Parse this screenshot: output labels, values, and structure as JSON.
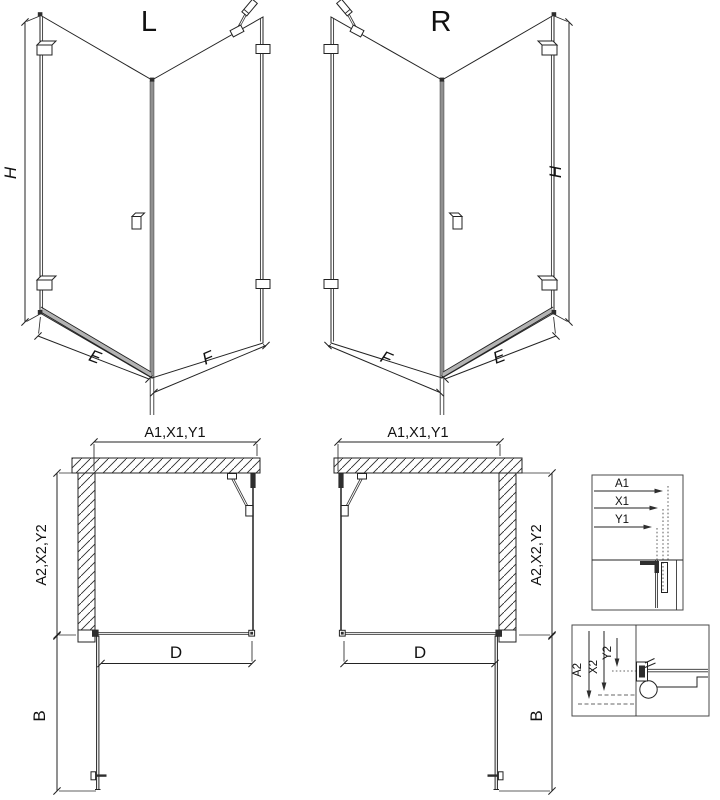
{
  "colors": {
    "line": "#232323",
    "rail_gray": "#b3b3b3",
    "background": "#ffffff"
  },
  "iso_left": {
    "title": "L",
    "height_label": "H",
    "door_width_label": "E",
    "side_width_label": "F"
  },
  "iso_right": {
    "title": "R",
    "height_label": "H",
    "door_width_label": "E",
    "side_width_label": "F"
  },
  "plan_left": {
    "top_dim_label": "A1,X1,Y1",
    "side_dim_label": "A2,X2,Y2",
    "entry_label": "D",
    "door_label": "B"
  },
  "plan_right": {
    "top_dim_label": "A1,X1,Y1",
    "side_dim_label": "A2,X2,Y2",
    "entry_label": "D",
    "door_label": "B"
  },
  "detail_top": {
    "dims": [
      "A1",
      "X1",
      "Y1"
    ]
  },
  "detail_bottom": {
    "dims": [
      "A2",
      "X2",
      "Y2"
    ]
  }
}
